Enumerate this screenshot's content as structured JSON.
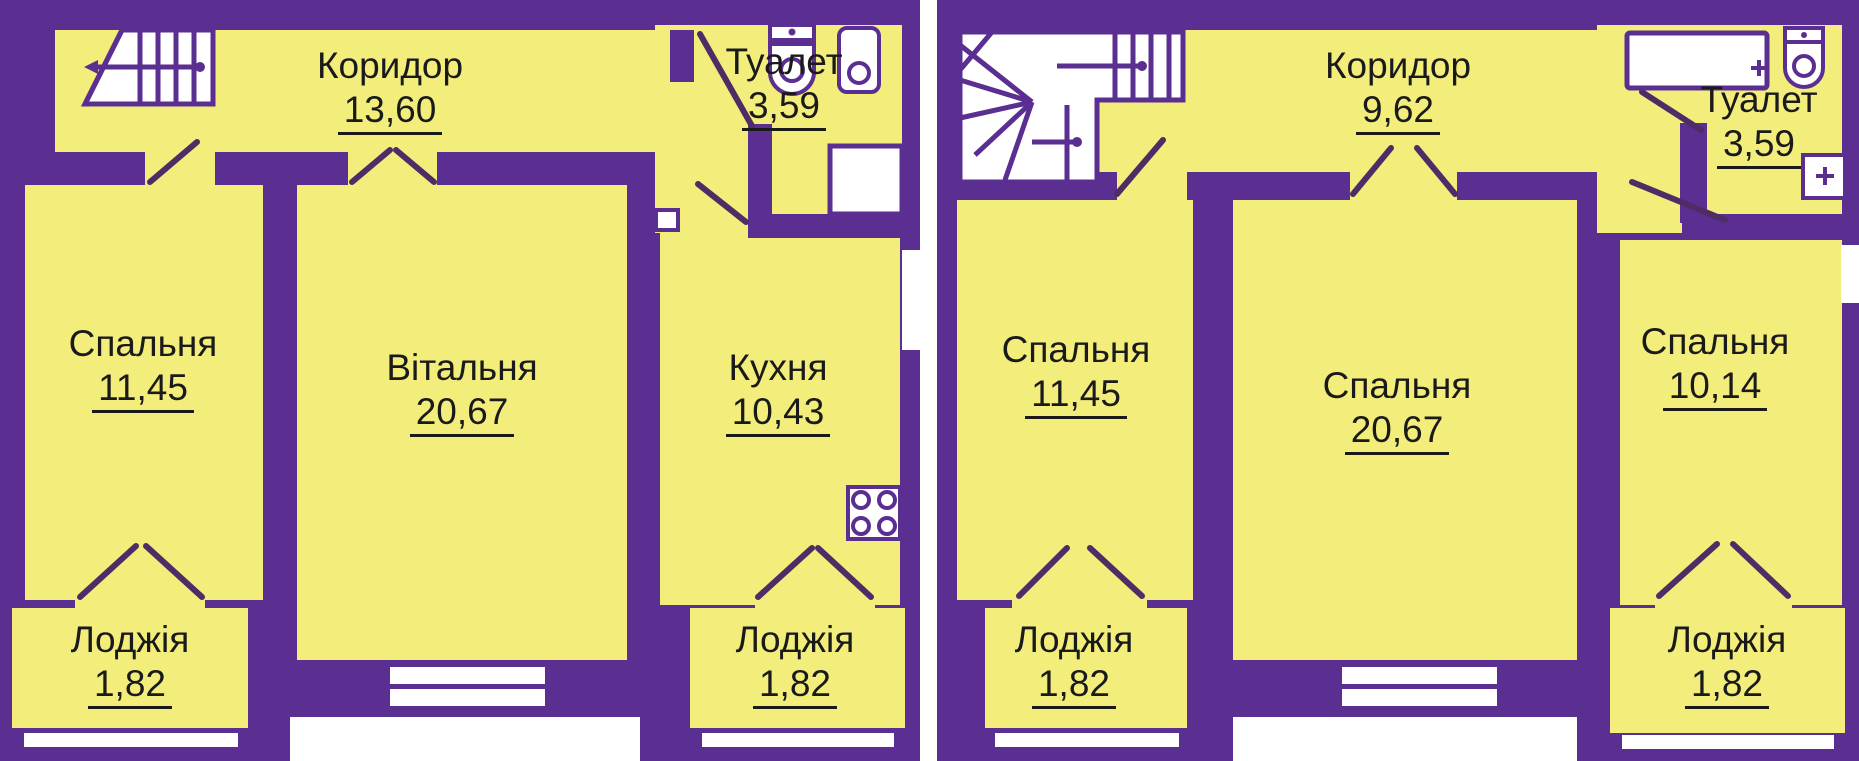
{
  "colors": {
    "wall": "#5b2e91",
    "room": "#f3ee7b",
    "line": "#4e2d66",
    "text": "#1a1a1a",
    "white": "#ffffff"
  },
  "icons": [
    "staircase-icon",
    "staircase-winder-icon",
    "toilet-wc-icon",
    "sink-icon",
    "bathtub-icon",
    "shower-tray-icon",
    "stove-burners-icon",
    "door-swing",
    "window"
  ],
  "plans": [
    {
      "id": "floor-plan-1",
      "rooms": [
        {
          "key": "corridor",
          "name": "Коридор",
          "area": "13,60"
        },
        {
          "key": "toilet",
          "name": "Туалет",
          "area": "3,59"
        },
        {
          "key": "bedroom",
          "name": "Спальня",
          "area": "11,45"
        },
        {
          "key": "living-room",
          "name": "Вітальня",
          "area": "20,67"
        },
        {
          "key": "kitchen",
          "name": "Кухня",
          "area": "10,43"
        },
        {
          "key": "loggia-left",
          "name": "Лоджія",
          "area": "1,82"
        },
        {
          "key": "loggia-right",
          "name": "Лоджія",
          "area": "1,82"
        }
      ]
    },
    {
      "id": "floor-plan-2",
      "rooms": [
        {
          "key": "corridor",
          "name": "Коридор",
          "area": "9,62"
        },
        {
          "key": "toilet",
          "name": "Туалет",
          "area": "3,59"
        },
        {
          "key": "bedroom-left",
          "name": "Спальня",
          "area": "11,45"
        },
        {
          "key": "bedroom-middle",
          "name": "Спальня",
          "area": "20,67"
        },
        {
          "key": "bedroom-right",
          "name": "Спальня",
          "area": "10,14"
        },
        {
          "key": "loggia-left",
          "name": "Лоджія",
          "area": "1,82"
        },
        {
          "key": "loggia-right",
          "name": "Лоджія",
          "area": "1,82"
        }
      ]
    }
  ]
}
